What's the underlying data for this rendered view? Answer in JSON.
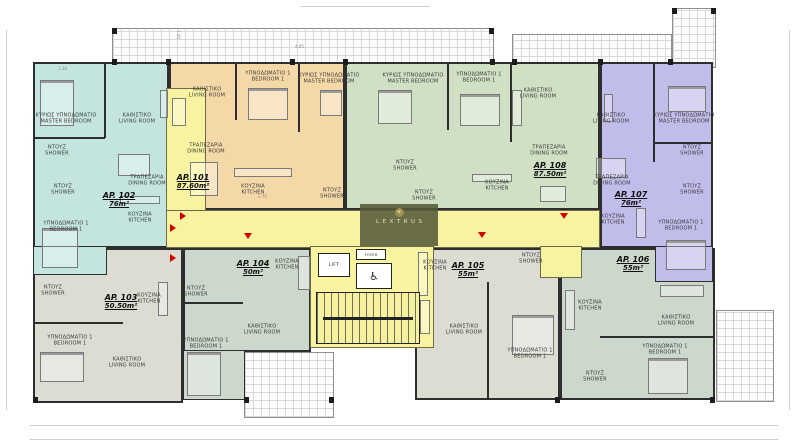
{
  "branding": {
    "logo_text": "LEXTRUS",
    "logo_icon": "asterisk-emblem"
  },
  "core": {
    "lift": "LIFT",
    "foyer": "FOYER"
  },
  "dimensions": {
    "d1": "4.85",
    "d2": "3.28",
    "d3": "2.70",
    "d4": "1.40"
  },
  "colors": {
    "corridor_yellow": "#f8f3a0",
    "wall_dark": "#2e2e2e",
    "entrance_marker_red": "#d40000",
    "banner_olive": "#565a39"
  },
  "apartments": [
    {
      "id": "AP. 101",
      "area": "87.60m²",
      "color": "#f5d8a7",
      "rooms": [
        {
          "gr": "ΚΑΘΙΣΤΙΚΟ",
          "en": "LIVING ROOM"
        },
        {
          "gr": "ΥΠΝΟΔΩΜΑΤΙΟ 1",
          "en": "BEDROOM 1"
        },
        {
          "gr": "ΚΥΡΙΩΣ ΥΠΝΟΔΩΜΑΤΙΟ",
          "en": "MASTER BEDROOM"
        },
        {
          "gr": "ΤΡΑΠΕΖΑΡΙΑ",
          "en": "DINING ROOM"
        },
        {
          "gr": "ΚΟΥΖΙΝΑ",
          "en": "KITCHEN"
        },
        {
          "gr": "ΝΤΟΥΖ",
          "en": "SHOWER"
        }
      ]
    },
    {
      "id": "AP. 102",
      "area": "76m²",
      "color": "#c4e5df",
      "rooms": [
        {
          "gr": "ΚΥΡΙΩΣ ΥΠΝΟΔΩΜΑΤΙΟ",
          "en": "MASTER BEDROOM"
        },
        {
          "gr": "ΚΑΘΙΣΤΙΚΟ",
          "en": "LIVING ROOM"
        },
        {
          "gr": "ΝΤΟΥΖ",
          "en": "SHOWER"
        },
        {
          "gr": "ΝΤΟΥΖ",
          "en": "SHOWER"
        },
        {
          "gr": "ΤΡΑΠΕΖΑΡΙΑ",
          "en": "DINING ROOM"
        },
        {
          "gr": "ΚΟΥΖΙΝΑ",
          "en": "KITCHEN"
        },
        {
          "gr": "ΥΠΝΟΔΩΜΑΤΙΟ 1",
          "en": "BEDROOM 1"
        }
      ]
    },
    {
      "id": "AP. 103",
      "area": "50.50m²",
      "color": "#dcdcd3",
      "rooms": [
        {
          "gr": "ΝΤΟΥΖ",
          "en": "SHOWER"
        },
        {
          "gr": "ΚΟΥΖΙΝΑ",
          "en": "KITCHEN"
        },
        {
          "gr": "ΥΠΝΟΔΩΜΑΤΙΟ 1",
          "en": "BEDROOM 1"
        },
        {
          "gr": "ΚΑΘΙΣΤΙΚΟ",
          "en": "LIVING ROOM"
        }
      ]
    },
    {
      "id": "AP. 104",
      "area": "50m²",
      "color": "#ccd8cc",
      "rooms": [
        {
          "gr": "ΝΤΟΥΖ",
          "en": "SHOWER"
        },
        {
          "gr": "ΚΟΥΖΙΝΑ",
          "en": "KITCHEN"
        },
        {
          "gr": "ΚΑΘΙΣΤΙΚΟ",
          "en": "LIVING ROOM"
        },
        {
          "gr": "ΥΠΝΟΔΩΜΑΤΙΟ 1",
          "en": "BEDROOM 1"
        }
      ]
    },
    {
      "id": "AP. 105",
      "area": "55m²",
      "color": "#dcdcd3",
      "rooms": [
        {
          "gr": "ΚΟΥΖΙΝΑ",
          "en": "KITCHEN"
        },
        {
          "gr": "ΝΤΟΥΖ",
          "en": "SHOWER"
        },
        {
          "gr": "ΚΑΘΙΣΤΙΚΟ",
          "en": "LIVING ROOM"
        },
        {
          "gr": "ΥΠΝΟΔΩΜΑΤΙΟ 1",
          "en": "BEDROOM 1"
        }
      ]
    },
    {
      "id": "AP. 106",
      "area": "55m²",
      "color": "#ccd8cc",
      "rooms": [
        {
          "gr": "ΚΟΥΖΙΝΑ",
          "en": "KITCHEN"
        },
        {
          "gr": "ΚΑΘΙΣΤΙΚΟ",
          "en": "LIVING ROOM"
        },
        {
          "gr": "ΥΠΝΟΔΩΜΑΤΙΟ 1",
          "en": "BEDROOM 1"
        },
        {
          "gr": "ΝΤΟΥΖ",
          "en": "SHOWER"
        }
      ]
    },
    {
      "id": "AP. 107",
      "area": "76m²",
      "color": "#c0bdea",
      "rooms": [
        {
          "gr": "ΚΑΘΙΣΤΙΚΟ",
          "en": "LIVING ROOM"
        },
        {
          "gr": "ΤΡΑΠΕΖΑΡΙΑ",
          "en": "DINING ROOM"
        },
        {
          "gr": "ΚΟΥΖΙΝΑ",
          "en": "KITCHEN"
        },
        {
          "gr": "ΚΥΡΙΩΣ ΥΠΝΟΔΩΜΑΤΙΟ",
          "en": "MASTER BEDROOM"
        },
        {
          "gr": "ΝΤΟΥΖ",
          "en": "SHOWER"
        },
        {
          "gr": "ΝΤΟΥΖ",
          "en": "SHOWER"
        },
        {
          "gr": "ΥΠΝΟΔΩΜΑΤΙΟ 1",
          "en": "BEDROOM 1"
        }
      ]
    },
    {
      "id": "AP. 108",
      "area": "87.50m²",
      "color": "#cfe0c5",
      "rooms": [
        {
          "gr": "ΚΥΡΙΩΣ ΥΠΝΟΔΩΜΑΤΙΟ",
          "en": "MASTER BEDROOM"
        },
        {
          "gr": "ΥΠΝΟΔΩΜΑΤΙΟ 1",
          "en": "BEDROOM 1"
        },
        {
          "gr": "ΝΤΟΥΖ",
          "en": "SHOWER"
        },
        {
          "gr": "ΝΤΟΥΖ",
          "en": "SHOWER"
        },
        {
          "gr": "ΚΟΥΖΙΝΑ",
          "en": "KITCHEN"
        },
        {
          "gr": "ΚΑΘΙΣΤΙΚΟ",
          "en": "LIVING ROOM"
        },
        {
          "gr": "ΤΡΑΠΕΖΑΡΙΑ",
          "en": "DINING ROOM"
        }
      ]
    }
  ]
}
